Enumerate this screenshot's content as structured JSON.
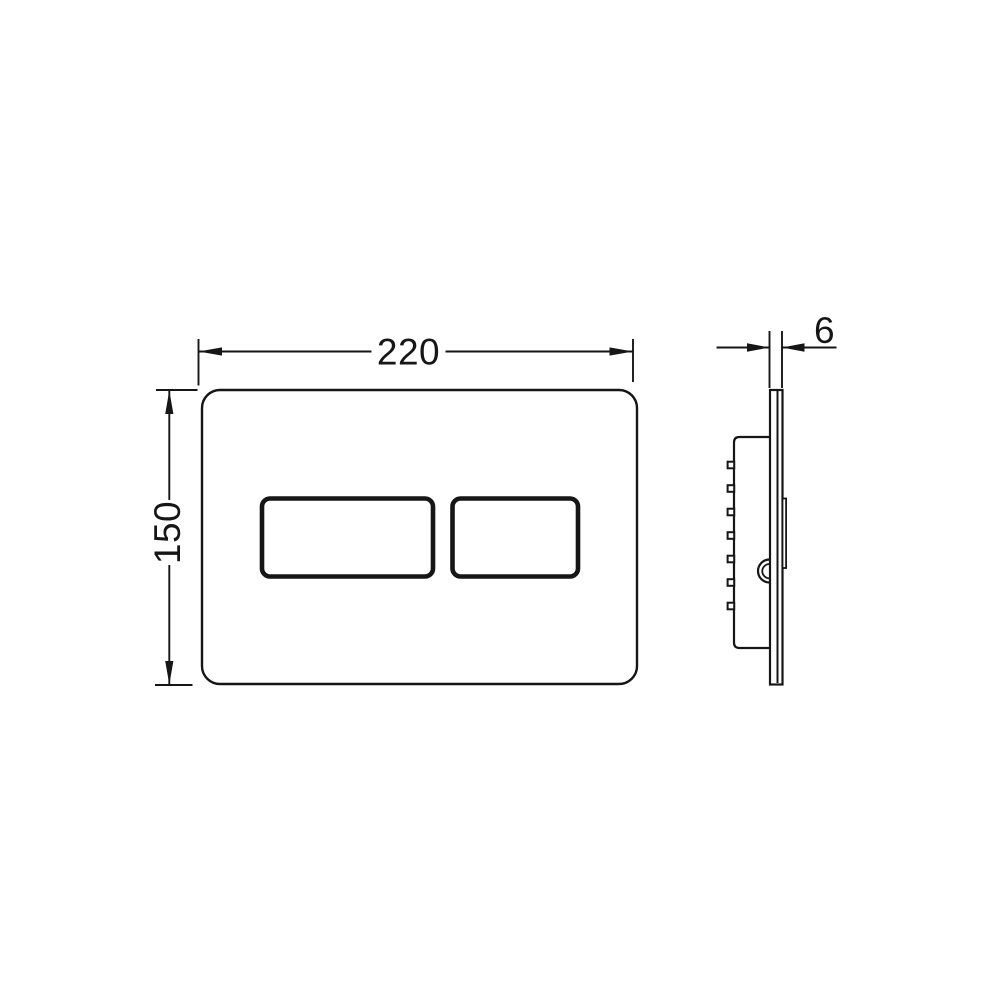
{
  "drawing": {
    "colors": {
      "line": "#161616",
      "background": "#ffffff"
    },
    "dimensions": {
      "front_width": "220",
      "front_height": "150",
      "side_thickness": "6"
    }
  }
}
